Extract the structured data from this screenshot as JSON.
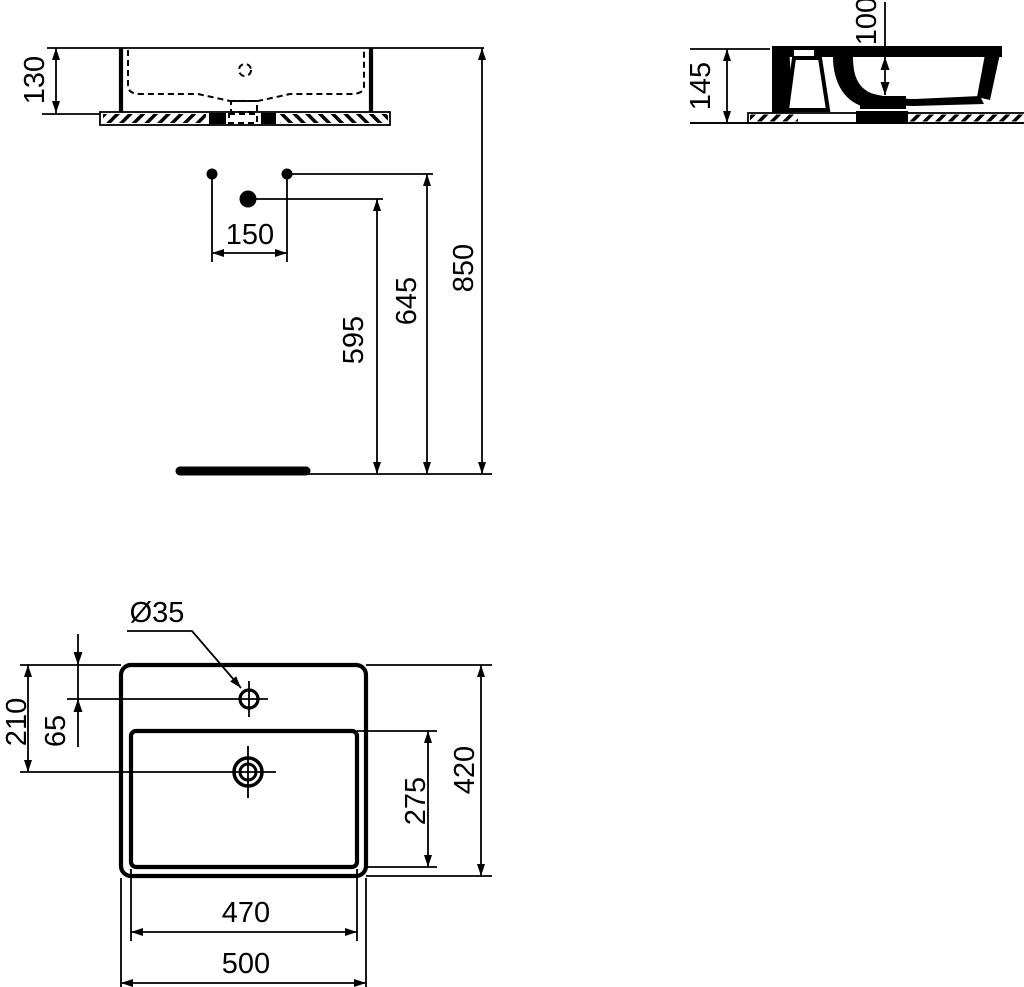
{
  "page": {
    "background": "#ffffff",
    "line_color": "#000000"
  },
  "views": {
    "front": {
      "dims": {
        "rim_height": "130"
      }
    },
    "side": {
      "dims": {
        "overall_height": "145",
        "inner_depth": "100"
      }
    },
    "installation": {
      "dims": {
        "fixing_hole_spacing": "150",
        "drain_height": "595",
        "fixing_height": "645",
        "rim_height_from_floor": "850"
      }
    },
    "plan": {
      "dims": {
        "tap_hole_diameter": "Ø35",
        "tap_hole_offset": "65",
        "drain_offset": "210",
        "overall_depth": "420",
        "bowl_depth": "275",
        "bowl_width": "470",
        "overall_width": "500"
      }
    }
  }
}
